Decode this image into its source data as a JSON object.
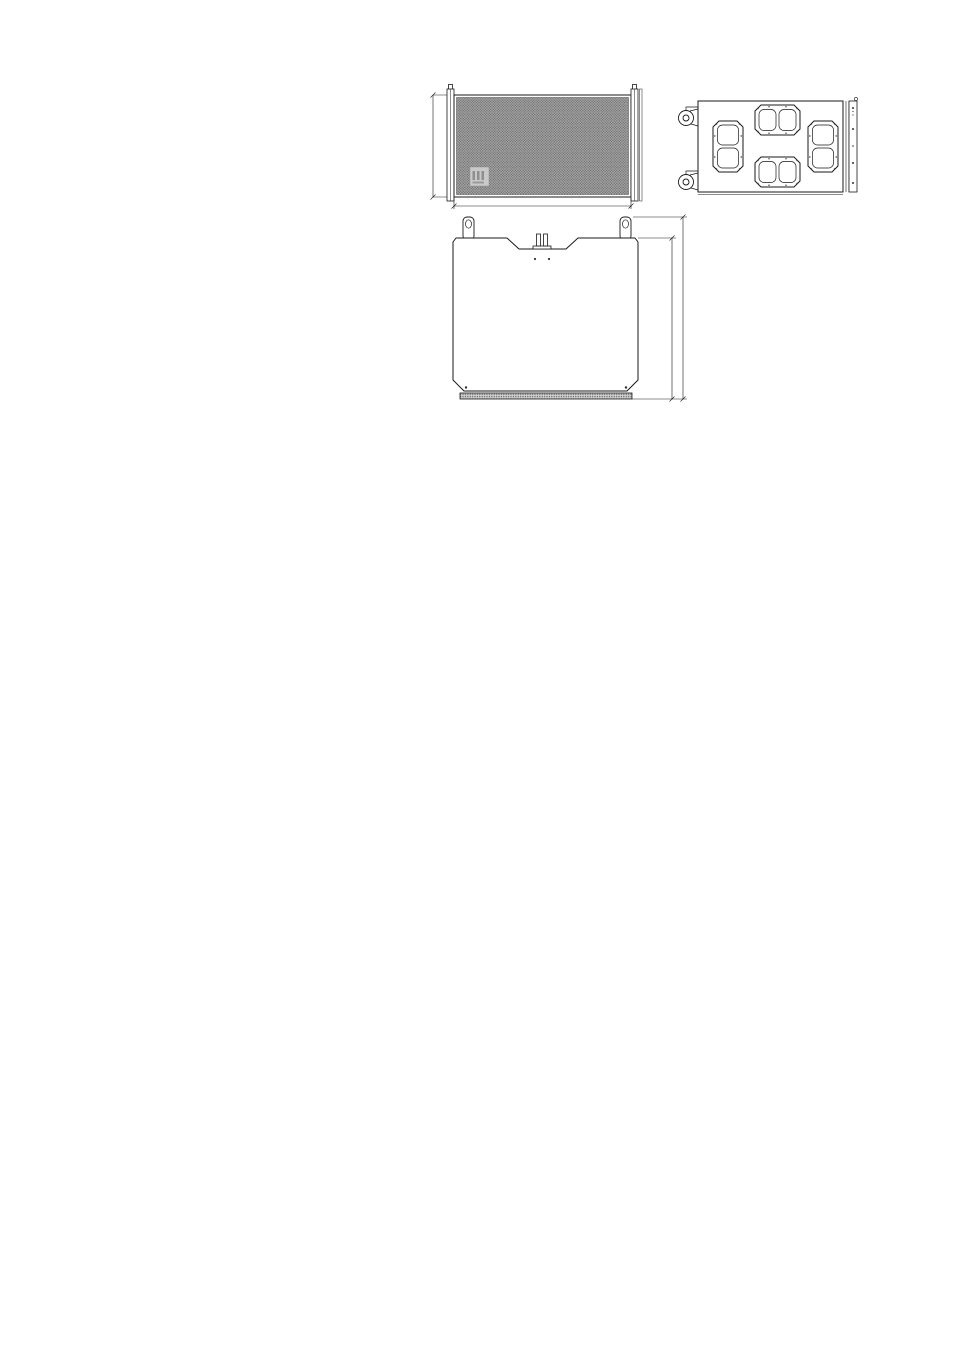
{
  "chart": {
    "chart_data": {
      "type": "line",
      "title": "",
      "x_scale": "log",
      "xlim": [
        20,
        20000
      ],
      "ylim": [
        -30,
        10
      ],
      "grid": true,
      "legend": "none",
      "y_ticks": [
        10,
        5,
        0,
        -5,
        -10,
        -15,
        -20,
        -25,
        -30
      ],
      "y_tick_labels": [
        "10",
        "5",
        "0",
        "-5",
        "-10",
        "-15",
        "-20",
        "-25",
        "-30"
      ],
      "y_minor_tick_step": 1,
      "x_ticks": [
        {
          "value": 20,
          "label": "20"
        },
        {
          "value": 100,
          "label": "100"
        },
        {
          "value": 1000,
          "label": "1k"
        },
        {
          "value": 10000,
          "label": "10k"
        },
        {
          "value": 20000,
          "label": "20k"
        }
      ],
      "x_gridlines": [
        20,
        30,
        40,
        50,
        60,
        70,
        80,
        90,
        100,
        200,
        300,
        400,
        500,
        600,
        700,
        800,
        900,
        1000,
        2000,
        3000,
        4000,
        5000,
        6000,
        7000,
        8000,
        9000,
        10000,
        20000
      ],
      "series": [
        {
          "name": "series-1",
          "x": [
            20,
            22,
            25,
            28,
            31,
            34,
            37,
            40,
            44,
            48,
            52,
            56,
            60,
            65,
            70,
            80,
            90,
            100,
            110,
            125,
            140,
            160,
            180,
            200,
            220,
            240,
            255
          ],
          "y": [
            -26,
            -21,
            -15,
            -10,
            -6.2,
            -3.2,
            -1.2,
            -0.3,
            0.2,
            0.3,
            0,
            -0.5,
            -1.1,
            -1.9,
            -2.7,
            -4.6,
            -6.5,
            -8.3,
            -9.9,
            -12.1,
            -14.2,
            -16.9,
            -19.6,
            -22.2,
            -25,
            -28,
            -30
          ]
        },
        {
          "name": "series-2",
          "x": [
            20,
            22,
            25,
            28,
            31,
            34,
            37,
            40,
            44,
            48,
            53,
            58,
            64,
            70,
            77,
            85,
            92,
            100,
            110,
            125,
            140,
            160,
            180,
            200,
            220,
            250,
            280,
            310,
            335
          ],
          "y": [
            -27,
            -22,
            -15.6,
            -10.4,
            -6.5,
            -3.4,
            -1.4,
            -0.4,
            0.2,
            0.5,
            0.4,
            0.1,
            -0.2,
            -0.4,
            -0.5,
            -0.6,
            -1.1,
            -2,
            -3.3,
            -5.3,
            -7.5,
            -10.3,
            -13,
            -15.4,
            -17.9,
            -21.7,
            -25.4,
            -28.6,
            -30
          ]
        }
      ]
    }
  },
  "front_view": {
    "width_label": "1100 [43.30\"]",
    "height_label": "540 [21.26\"]"
  },
  "top_view": {
    "depth_label": "945 [37.20\"]",
    "overall_depth_label": "1062.50 [41.83\"]"
  },
  "colors": {
    "line": "#1a1a1a",
    "grille_base": "#a6a6a6",
    "grille_dot": "#5f5f5f"
  }
}
